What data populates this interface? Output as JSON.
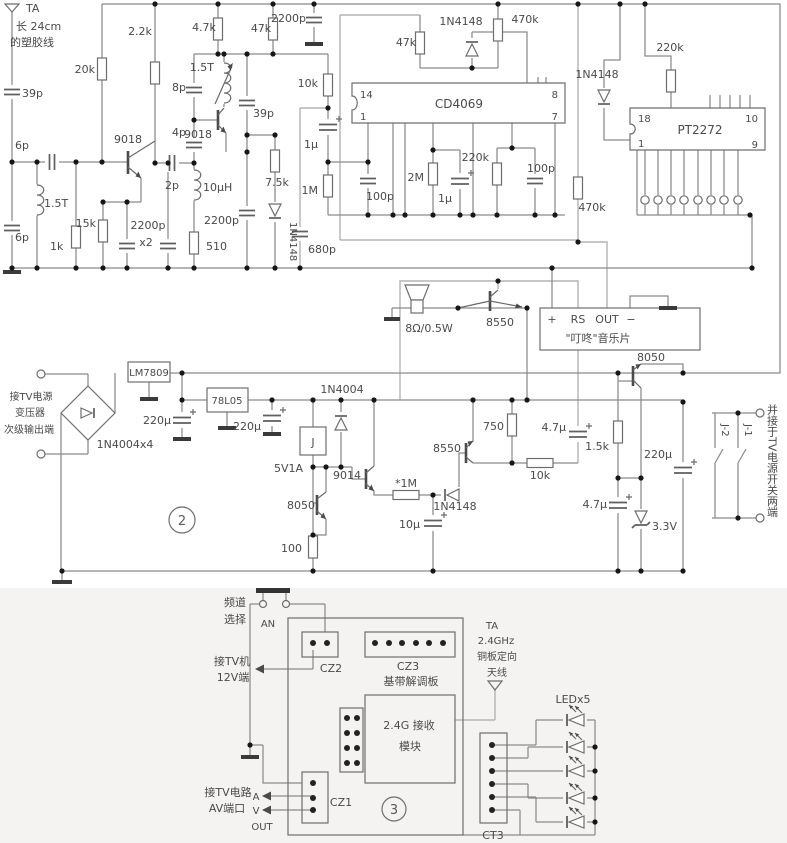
{
  "colors": {
    "background": "#ffffff",
    "ink": "#4a4a4a",
    "wire": "#8a8a8a",
    "wire_light": "#b3b3b3"
  },
  "s1": {
    "ta": "TA",
    "ant1": "长 24cm",
    "ant2": "的塑胶线",
    "c39a": "39p",
    "c6a": "6p",
    "l15a": "1.5T",
    "c6b": "6p",
    "r1k": "1k",
    "r15k": "15k",
    "r20k": "20k",
    "r2k2": "2.2k",
    "q1": "9018",
    "c2p": "2p",
    "c2200": "2200p",
    "x2": "x2",
    "r510": "510",
    "l10u": "10µH",
    "c4p": "4p",
    "c8p": "8p",
    "l15b": "1.5T",
    "q2": "9018",
    "c39b": "39p",
    "r4k7": "4.7k",
    "r47a": "47k",
    "r7k5": "7.5k",
    "d1": "1N4148",
    "c2200b": "2200p",
    "c2200t": "2200p",
    "r10k": "10k",
    "c1ua": "1µ",
    "r1m": "1M",
    "c680": "680p",
    "c100a": "100p",
    "ic1": "CD4069",
    "p14": "14",
    "p1": "1",
    "p8": "8",
    "p7": "7",
    "r47b": "47k",
    "d2": "1N4148",
    "r470a": "470k",
    "r2m": "2M",
    "c1ub": "1µ",
    "r220a": "220k",
    "c100b": "100p",
    "r470b": "470k",
    "d3": "1N4148",
    "r220b": "220k",
    "ic2": "PT2272",
    "p18": "18",
    "p1b": "1",
    "p10": "10",
    "p9": "9"
  },
  "s2": {
    "spk": "8Ω/0.5W",
    "q3": "8550",
    "mp": "+",
    "mrs": "RS",
    "mout": "OUT",
    "mm": "−",
    "mname": "\"叮咚\"音乐片",
    "q4": "8050",
    "in1": "接TV电源",
    "in2": "变压器",
    "in3": "次级输出端",
    "br": "1N4004x4",
    "u1": "LM7809",
    "c220a": "220µ",
    "u2": "78L05",
    "c220b": "220µ",
    "d4": "1N4004",
    "j": "J",
    "jspec": "5V1A",
    "q5": "9014",
    "rm": "*1M",
    "q6": "8550",
    "d5": "1N4148",
    "c10u": "10µ",
    "r750": "750",
    "r10kb": "10k",
    "c47a": "4.7µ",
    "r1k5": "1.5k",
    "c220c": "220µ",
    "c47b": "4.7µ",
    "dz": "3.3V",
    "num": "2",
    "q7": "8050",
    "r100": "100",
    "j1": "J-1",
    "j2": "J-2",
    "note": "并接于TV电源开关两端"
  },
  "s3": {
    "ch1": "频道",
    "ch2": "选择",
    "an": "AN",
    "cz2": "CZ2",
    "cz3": "CZ3",
    "bb": "基带解调板",
    "tv1": "接TV机",
    "tv2": "12V端",
    "mod1": "2.4G 接收",
    "mod2": "模块",
    "ta": "TA",
    "ghz": "2.4GHz",
    "cu": "铜板定向",
    "ant": "天线",
    "led": "LEDx5",
    "ct3": "CT3",
    "cz1": "CZ1",
    "av1": "接TV电路",
    "av2": "AV端口",
    "a": "A",
    "v": "V",
    "out": "OUT",
    "num": "3"
  }
}
